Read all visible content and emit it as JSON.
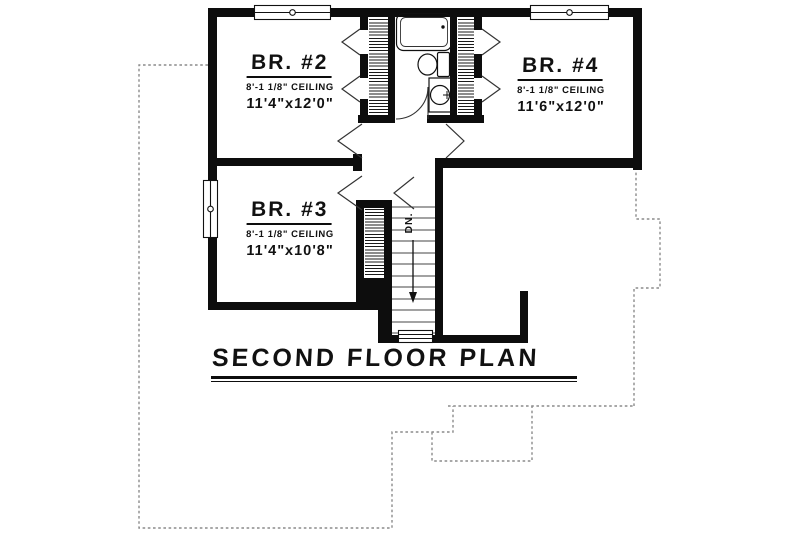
{
  "title": {
    "text": "SECOND FLOOR PLAN"
  },
  "rooms": [
    {
      "name": "BR. #2",
      "ceiling": "8'-1 1/8\" CEILING",
      "dims": "11'4\"x12'0\""
    },
    {
      "name": "BR. #4",
      "ceiling": "8'-1 1/8\" CEILING",
      "dims": "11'6\"x12'0\""
    },
    {
      "name": "BR. #3",
      "ceiling": "8'-1 1/8\" CEILING",
      "dims": "11'4\"x10'8\""
    }
  ],
  "stairs": {
    "down_label": "DN."
  },
  "colors": {
    "wall": "#0d0d0d",
    "thin_line": "#333333",
    "dotted_outline": "#8c8c8c",
    "background": "#ffffff"
  }
}
